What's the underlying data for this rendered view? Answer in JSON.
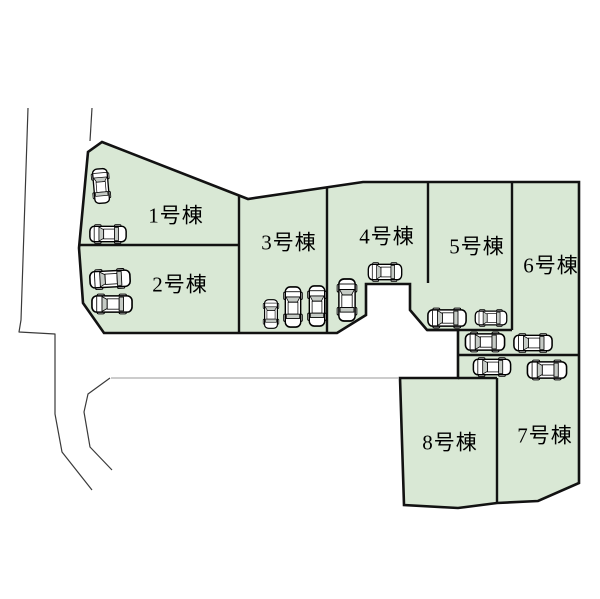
{
  "site_plan": {
    "title": "区画図",
    "colors": {
      "parcel_fill": "#d9e8d5",
      "outline": "#121212",
      "road_line": "#3a3a3a",
      "thin_road_line": "#9a9a9a",
      "car_body": "#ffffff",
      "car_window": "#c6cbc6"
    },
    "lots": [
      {
        "id": "lot-1",
        "label": "1号棟"
      },
      {
        "id": "lot-2",
        "label": "2号棟"
      },
      {
        "id": "lot-3",
        "label": "3号棟"
      },
      {
        "id": "lot-4",
        "label": "4号棟"
      },
      {
        "id": "lot-5",
        "label": "5号棟"
      },
      {
        "id": "lot-6",
        "label": "6号棟"
      },
      {
        "id": "lot-7",
        "label": "7号棟"
      },
      {
        "id": "lot-8",
        "label": "8号棟"
      }
    ],
    "cars": [
      {
        "x": 101,
        "y": 186,
        "len": 36,
        "wid": 17,
        "angle": 85
      },
      {
        "x": 108,
        "y": 234,
        "len": 38,
        "wid": 18,
        "angle": 0
      },
      {
        "x": 110,
        "y": 279,
        "len": 42,
        "wid": 19,
        "angle": -3
      },
      {
        "x": 112,
        "y": 304,
        "len": 42,
        "wid": 19,
        "angle": 0
      },
      {
        "x": 271,
        "y": 314,
        "len": 30,
        "wid": 15,
        "angle": 90
      },
      {
        "x": 293,
        "y": 307,
        "len": 42,
        "wid": 18,
        "angle": 90
      },
      {
        "x": 317,
        "y": 306,
        "len": 42,
        "wid": 18,
        "angle": 90
      },
      {
        "x": 347,
        "y": 300,
        "len": 44,
        "wid": 19,
        "angle": 90
      },
      {
        "x": 385,
        "y": 272,
        "len": 35,
        "wid": 18,
        "angle": 0
      },
      {
        "x": 447,
        "y": 318,
        "len": 40,
        "wid": 19,
        "angle": 0
      },
      {
        "x": 491,
        "y": 318,
        "len": 33,
        "wid": 16,
        "angle": 0
      },
      {
        "x": 485,
        "y": 342,
        "len": 41,
        "wid": 19,
        "angle": 0
      },
      {
        "x": 533,
        "y": 343,
        "len": 40,
        "wid": 18,
        "angle": 0
      },
      {
        "x": 492,
        "y": 367,
        "len": 39,
        "wid": 18,
        "angle": 0
      },
      {
        "x": 547,
        "y": 370,
        "len": 41,
        "wid": 19,
        "angle": 0
      }
    ]
  }
}
